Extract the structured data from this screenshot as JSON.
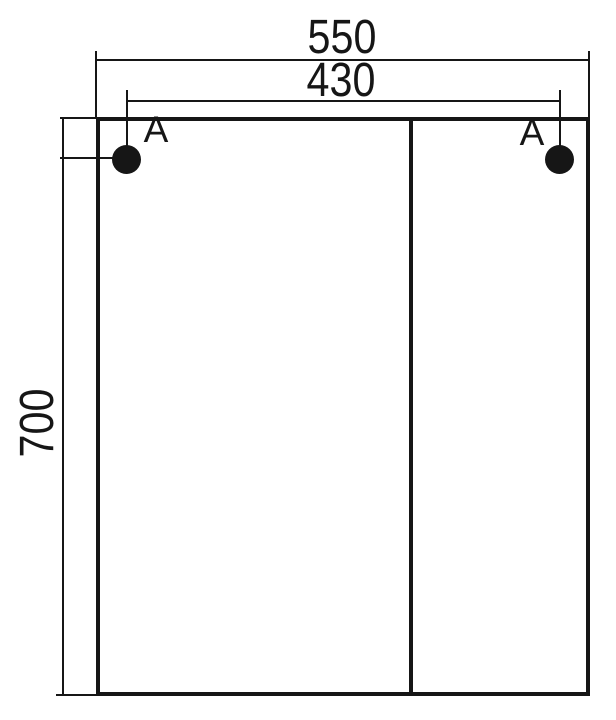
{
  "drawing": {
    "type": "cabinet-front-dimension-drawing",
    "line_color": "#161616",
    "background": "#ffffff",
    "dimensions": {
      "width": "550",
      "hole_spacing": "430",
      "height": "700"
    },
    "labels": {
      "hole_left": "A",
      "hole_right": "A"
    }
  }
}
